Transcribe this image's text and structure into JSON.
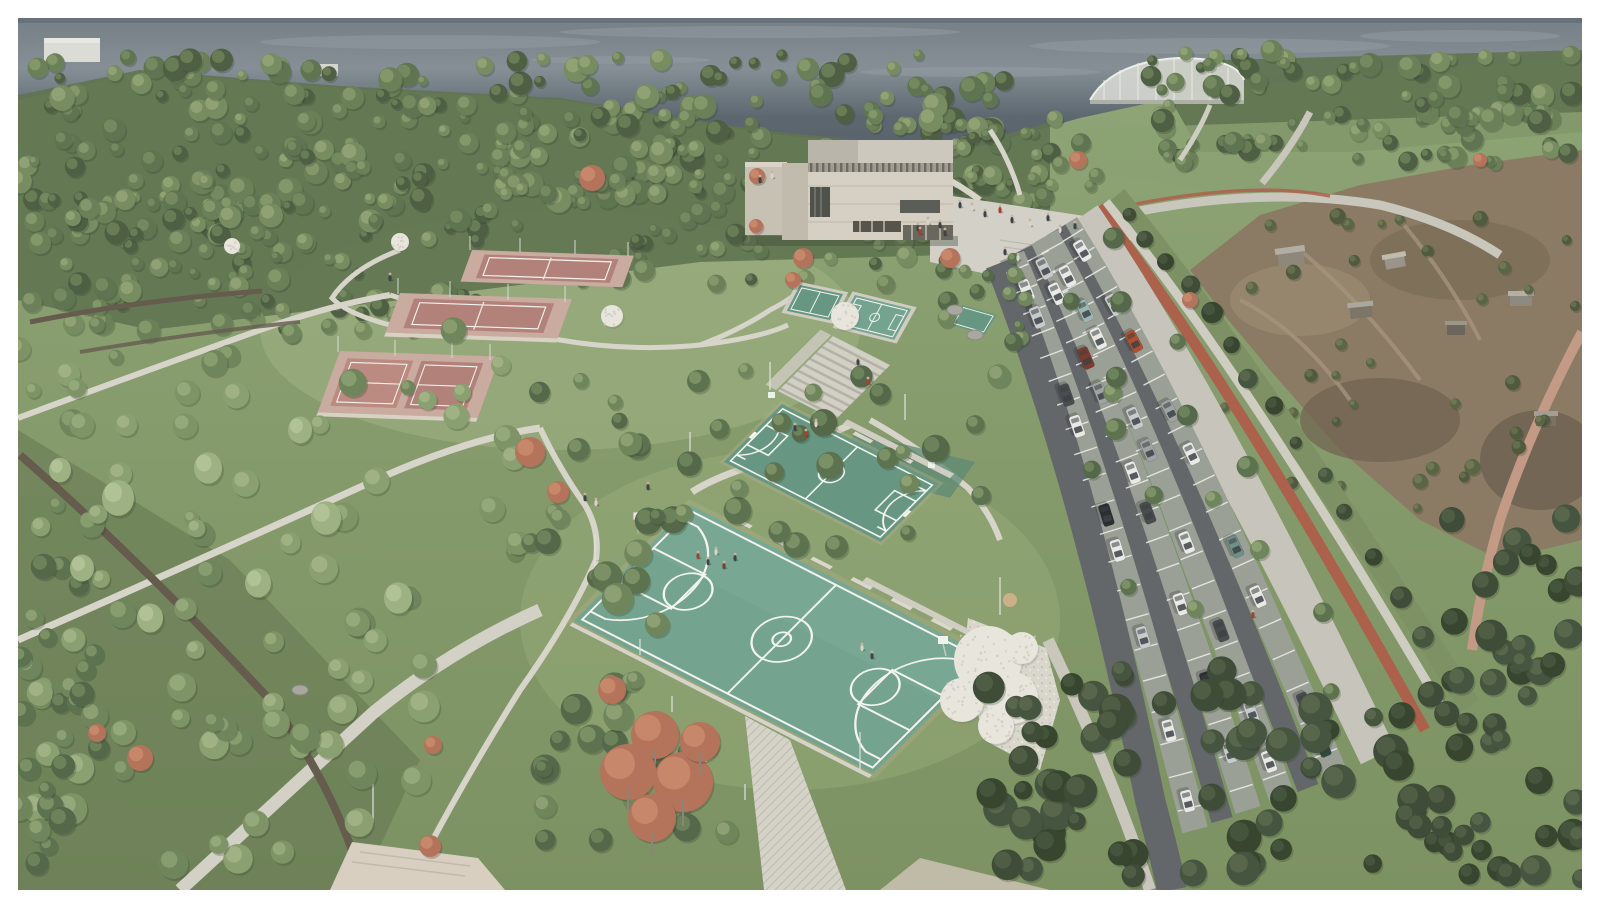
{
  "meta": {
    "type": "architectural-aerial-render",
    "title": "Hillside park and sports complex — aerial visualization",
    "description": "Aerial architectural rendering of a hillside waterfront park: three clay tennis court terraces, two teal basketball courts with players, small practice courts, a concrete cultural building with entry plaza and wide stairs, a tree-lined angled parking lot with a red bike lane promenade, dry scrubland with houses to the right, dense tree canopy and a dark sea horizon."
  },
  "palette": {
    "frame": "#ffffff",
    "water": "#5d6770",
    "water_light": "#97a0a5",
    "land": "#879c6d",
    "canopy": "#5f7350",
    "court_teal": "#74a38f",
    "court_teal_dark": "#679782",
    "court_line": "#f2f4ee",
    "tennis_clay": "#b2817a",
    "tennis_apron": "#c9ab9f",
    "bldg_front": "#d5d0c3",
    "bldg_side": "#c0bbad",
    "bldg_rear": "#b9b5ab",
    "bldg_rear2": "#ccc8bd",
    "plaza": "#d2d0c7",
    "path_light": "#d7d4ca",
    "path_dirt": "#655c4e",
    "asphalt": "#63676a",
    "stall": "#9aa096",
    "stall_line": "#e9ebe5",
    "promenade": "#c7c5bb",
    "bike": "#ab614c",
    "scrub": "#8b7b64",
    "scrub_dark": "#6f6250",
    "tree_red": "#b4735b",
    "tree_white": "#e7e5dc",
    "car_white": "#e9e9e6",
    "car_silver": "#c7cbcb",
    "car_gray": "#9fa3a4",
    "car_dark": "#4a4d4f",
    "car_black": "#2c2f31",
    "car_red": "#b0502f",
    "car_teal": "#9cb7b2"
  },
  "scene": {
    "water": {
      "label": "sea horizon with light streaks"
    },
    "sports_hall": {
      "label": "arched-roof sports hall on the ridge"
    },
    "tennis_courts": {
      "count": 3,
      "label": "terraced clay tennis courts"
    },
    "basketball_courts": {
      "count": 2,
      "label": "teal basketball courts with white markings"
    },
    "mini_courts": {
      "count": 3,
      "label": "small teal practice courts by the building"
    },
    "building": {
      "label": "concrete cultural / sports building",
      "volumes": 2
    },
    "plaza": {
      "label": "entry plaza with steps and visitors"
    },
    "stairs": {
      "label": "wide park stairs"
    },
    "parking": {
      "label": "tree-lined parking lot",
      "aisles": 3,
      "cars_approx": 36
    },
    "promenade": {
      "label": "paved promenade with red bike lane"
    },
    "scrubland": {
      "label": "dry hillside with scattered houses"
    },
    "meadow": {
      "label": "sloped meadows with willows and red maples"
    },
    "people_approx": 30
  }
}
